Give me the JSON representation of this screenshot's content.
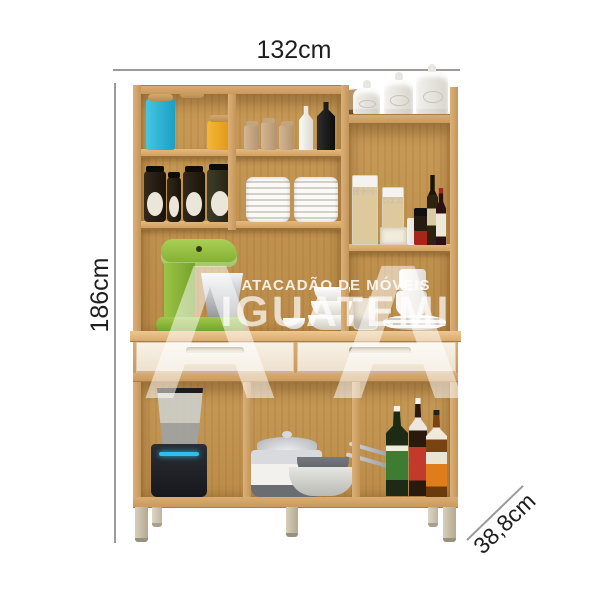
{
  "dimensions": {
    "width": "132cm",
    "height": "186cm",
    "depth": "38,8cm"
  },
  "watermark": {
    "monogram_left": "A",
    "monogram_right": "A",
    "line1": "ATACADÃO DE MÓVEIS",
    "line2": "IGUATEMI"
  },
  "colors": {
    "background": "#ffffff",
    "wood_face": "#d0a266",
    "wood_interior": "#c0924f",
    "drawer_front": "#f5ecdd",
    "leg": "#c8bea8",
    "dimension_line": "#9b9b9b",
    "dimension_text": "#1e1e1e",
    "watermark_white": "#ffffff",
    "mixer_green": "#8cb83e",
    "canister_blue": "#2ab5d8",
    "canister_green": "#4fae37",
    "canister_yellow": "#f0a72b"
  },
  "items": [
    "blue storage canister",
    "green storage canister",
    "yellow storage canister",
    "spice jars",
    "white bottle",
    "black bottle",
    "preserve jars with labels",
    "two stacks of white plates",
    "white ceramic canisters",
    "kraft paper bag",
    "cereal dispensers",
    "pasta box",
    "oil bottle",
    "vinegar bottle",
    "green stand mixer with steel bowl",
    "white bowls",
    "cups and saucers",
    "blender",
    "stainless pot with lid",
    "frying pans",
    "syrup bottles"
  ]
}
